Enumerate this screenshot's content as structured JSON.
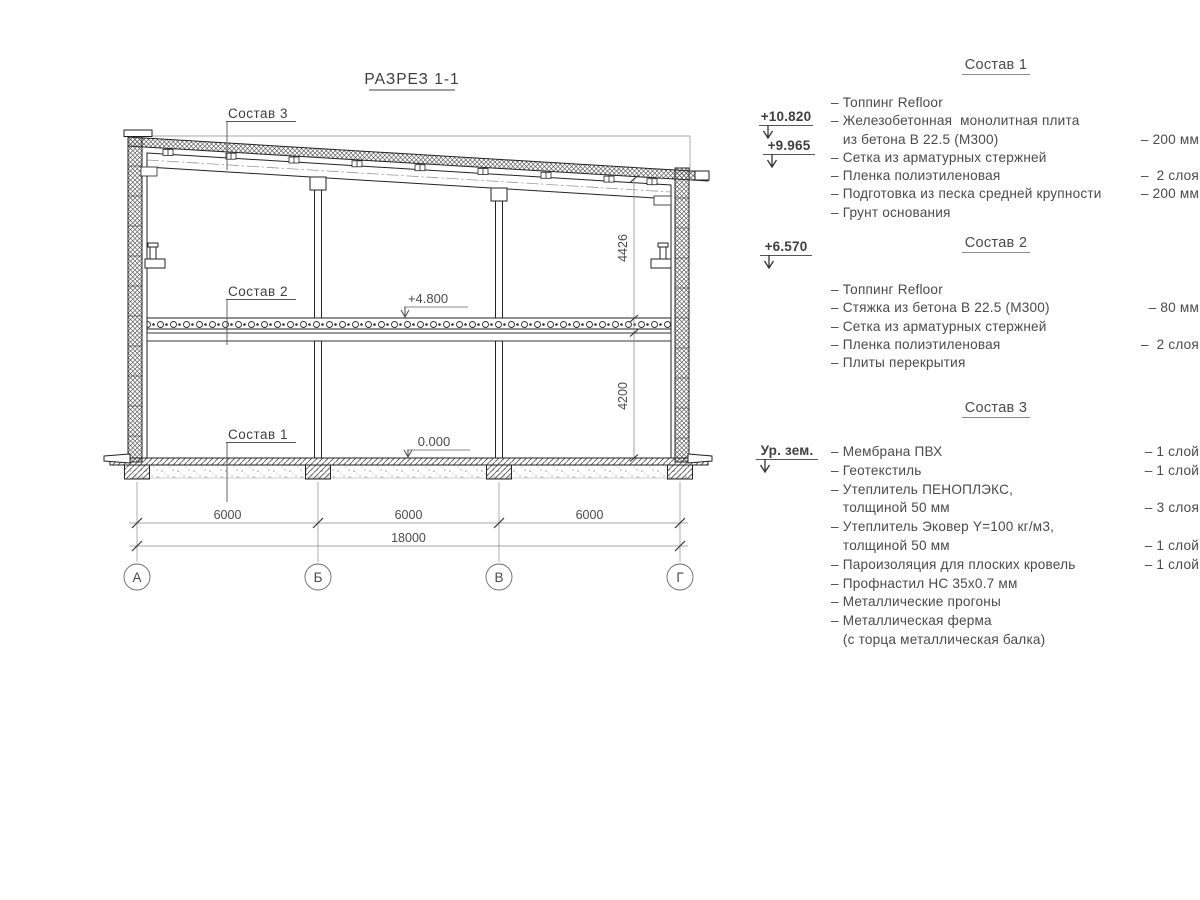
{
  "drawing": {
    "title": "РАЗРЕЗ 1-1",
    "callouts": {
      "c3": "Состав 3",
      "c2": "Состав 2",
      "c1": "Состав 1"
    },
    "elevations": {
      "mid": "+4.800",
      "zero": "0.000"
    },
    "dims": {
      "span1": "6000",
      "span2": "6000",
      "span3": "6000",
      "total": "18000",
      "upper": "4426",
      "lower": "4200"
    },
    "axes": [
      "А",
      "Б",
      "В",
      "Г"
    ]
  },
  "marks": {
    "m1": "+10.820",
    "m2": "+9.965",
    "m3": "+6.570",
    "m4": "Ур. зем."
  },
  "lists": {
    "s1": {
      "title": "Состав 1",
      "rows": [
        {
          "text": "– Топпинг Refloor",
          "qty": ""
        },
        {
          "text": "– Железобетонная  монолитная плита",
          "qty": ""
        },
        {
          "text": "   из бетона В 22.5 (М300)",
          "qty": "– 200 мм"
        },
        {
          "text": "– Сетка из арматурных стержней",
          "qty": ""
        },
        {
          "text": "– Пленка полиэтиленовая",
          "qty": "–  2 слоя"
        },
        {
          "text": "– Подготовка из песка средней крупности",
          "qty": "– 200 мм"
        },
        {
          "text": "– Грунт основания",
          "qty": ""
        }
      ]
    },
    "s2": {
      "title": "Состав 2",
      "rows": [
        {
          "text": "– Топпинг Refloor",
          "qty": ""
        },
        {
          "text": "– Стяжка из бетона В 22.5 (М300)",
          "qty": "– 80 мм"
        },
        {
          "text": "– Сетка из арматурных стержней",
          "qty": ""
        },
        {
          "text": "– Пленка полиэтиленовая",
          "qty": "–  2 слоя"
        },
        {
          "text": "– Плиты перекрытия",
          "qty": ""
        }
      ]
    },
    "s3": {
      "title": "Состав 3",
      "rows": [
        {
          "text": "– Мембрана ПВХ",
          "qty": "– 1 слой"
        },
        {
          "text": "– Геотекстиль",
          "qty": "– 1 слой"
        },
        {
          "text": "– Утеплитель ПЕНОПЛЭКС,",
          "qty": ""
        },
        {
          "text": "   толщиной 50 мм",
          "qty": "– 3 слоя"
        },
        {
          "text": "– Утеплитель Эковер Y=100 кг/м3,",
          "qty": ""
        },
        {
          "text": "   толщиной 50 мм",
          "qty": "– 1 слой"
        },
        {
          "text": "– Пароизоляция для плоских кровель",
          "qty": "– 1 слой"
        },
        {
          "text": "– Профнастил НС 35х0.7 мм",
          "qty": ""
        },
        {
          "text": "– Металлические прогоны",
          "qty": ""
        },
        {
          "text": "– Металлическая ферма",
          "qty": ""
        },
        {
          "text": "   (с торца металлическая балка)",
          "qty": ""
        }
      ]
    }
  }
}
